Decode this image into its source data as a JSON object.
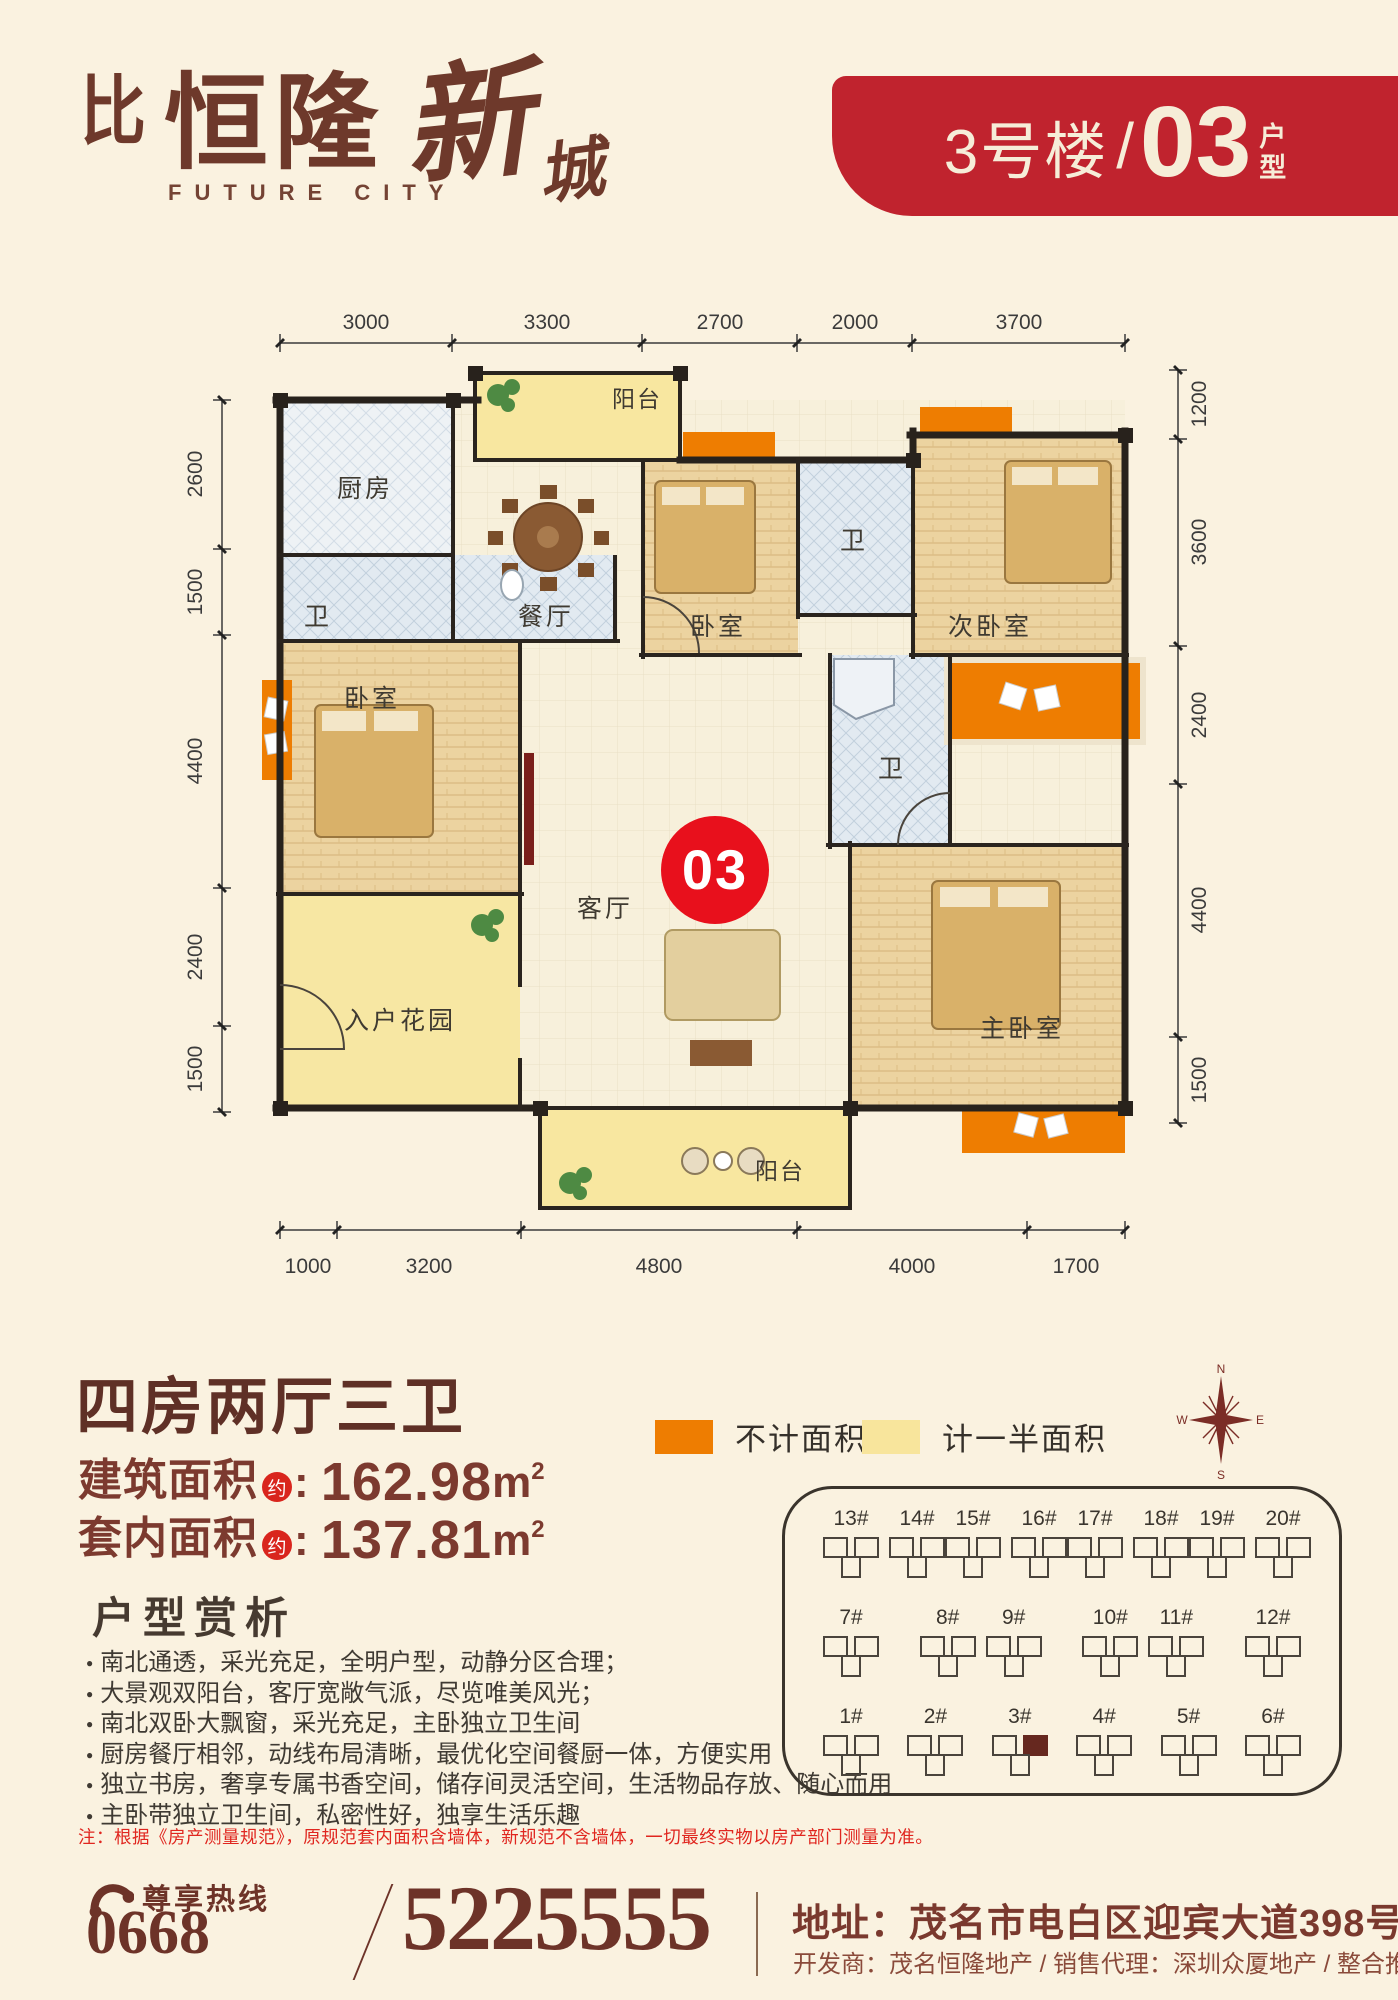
{
  "header": {
    "logo": {
      "monogram": "比",
      "name_main": "恒隆",
      "name_script_1": "新",
      "name_script_2": "城",
      "name_en": "FUTURE CITY"
    },
    "banner": {
      "building": "3号楼",
      "separator": "/",
      "unit": "03",
      "type_char_top": "户",
      "type_char_bottom": "型"
    }
  },
  "floorplan": {
    "unit_badge": "03",
    "dims": {
      "top": [
        "3000",
        "3300",
        "2700",
        "2000",
        "3700"
      ],
      "bottom": [
        "1000",
        "3200",
        "4800",
        "4000",
        "1700"
      ],
      "left": [
        "2600",
        "1500",
        "4400",
        "2400",
        "1500"
      ],
      "right": [
        "1200",
        "3600",
        "2400",
        "4400",
        "1500"
      ]
    },
    "rooms": {
      "balcony_top": "阳台",
      "kitchen": "厨房",
      "bath_guest": "卫",
      "dining": "餐厅",
      "bedroom_top": "卧室",
      "bath_top": "卫",
      "bedroom_second": "次卧室",
      "bedroom_left": "卧室",
      "living": "客厅",
      "bath_master": "卫",
      "entry_garden": "入户花园",
      "master_bedroom": "主卧室",
      "balcony_bottom": "阳台"
    }
  },
  "info": {
    "title": "四房两厅三卫",
    "area_build_label": "建筑面积",
    "area_inner_label": "套内面积",
    "approx": "约",
    "colon": ": ",
    "area_build_value": "162.98",
    "area_inner_value": "137.81",
    "unit": "m",
    "sup": "2"
  },
  "legend": {
    "no_area_label": "不计面积",
    "no_area_color": "#ee7d01",
    "half_area_label": "计一半面积",
    "half_area_color": "#f8e59c"
  },
  "compass": {
    "n": "N",
    "e": "E",
    "s": "S",
    "w": "W"
  },
  "analysis": {
    "title": "户型赏析",
    "bullets": [
      "南北通透，采光充足，全明户型，动静分区合理；",
      "大景观双阳台，客厅宽敞气派，尽览唯美风光；",
      "南北双卧大飘窗，采光充足，主卧独立卫生间",
      "厨房餐厅相邻，动线布局清晰，最优化空间餐厨一体，方便实用",
      "独立书房，奢享专属书香空间，储存间灵活空间，生活物品存放、随心而用",
      "主卧带独立卫生间，私密性好，独享生活乐趣"
    ]
  },
  "note": "注：根据《房产测量规范》，原规范套内面积含墙体，新规范不含墙体，一切最终实物以房产部门测量为准。",
  "siteplan": {
    "row1": [
      {
        "a": "13#",
        "b": "14#"
      },
      {
        "a": "15#",
        "b": "16#"
      },
      {
        "a": "17#",
        "b": "18#"
      },
      {
        "a": "19#",
        "b": "20#"
      }
    ],
    "row2": [
      {
        "a": "7#"
      },
      {
        "a": "8#",
        "b": "9#"
      },
      {
        "a": "10#",
        "b": "11#"
      },
      {
        "a": "12#"
      }
    ],
    "row3": [
      {
        "a": "1#"
      },
      {
        "a": "2#"
      },
      {
        "a": "3#"
      },
      {
        "a": "4#"
      },
      {
        "a": "5#"
      },
      {
        "a": "6#"
      }
    ],
    "highlighted": "3#"
  },
  "footer": {
    "hotline_label": "尊享热线",
    "area_code": "0668",
    "phone": "5225555",
    "address": "地址：茂名市电白区迎宾大道398号",
    "credits": "开发商：茂名恒隆地产 / 销售代理：深圳众厦地产 / 整合推广：广东蓝狮"
  }
}
